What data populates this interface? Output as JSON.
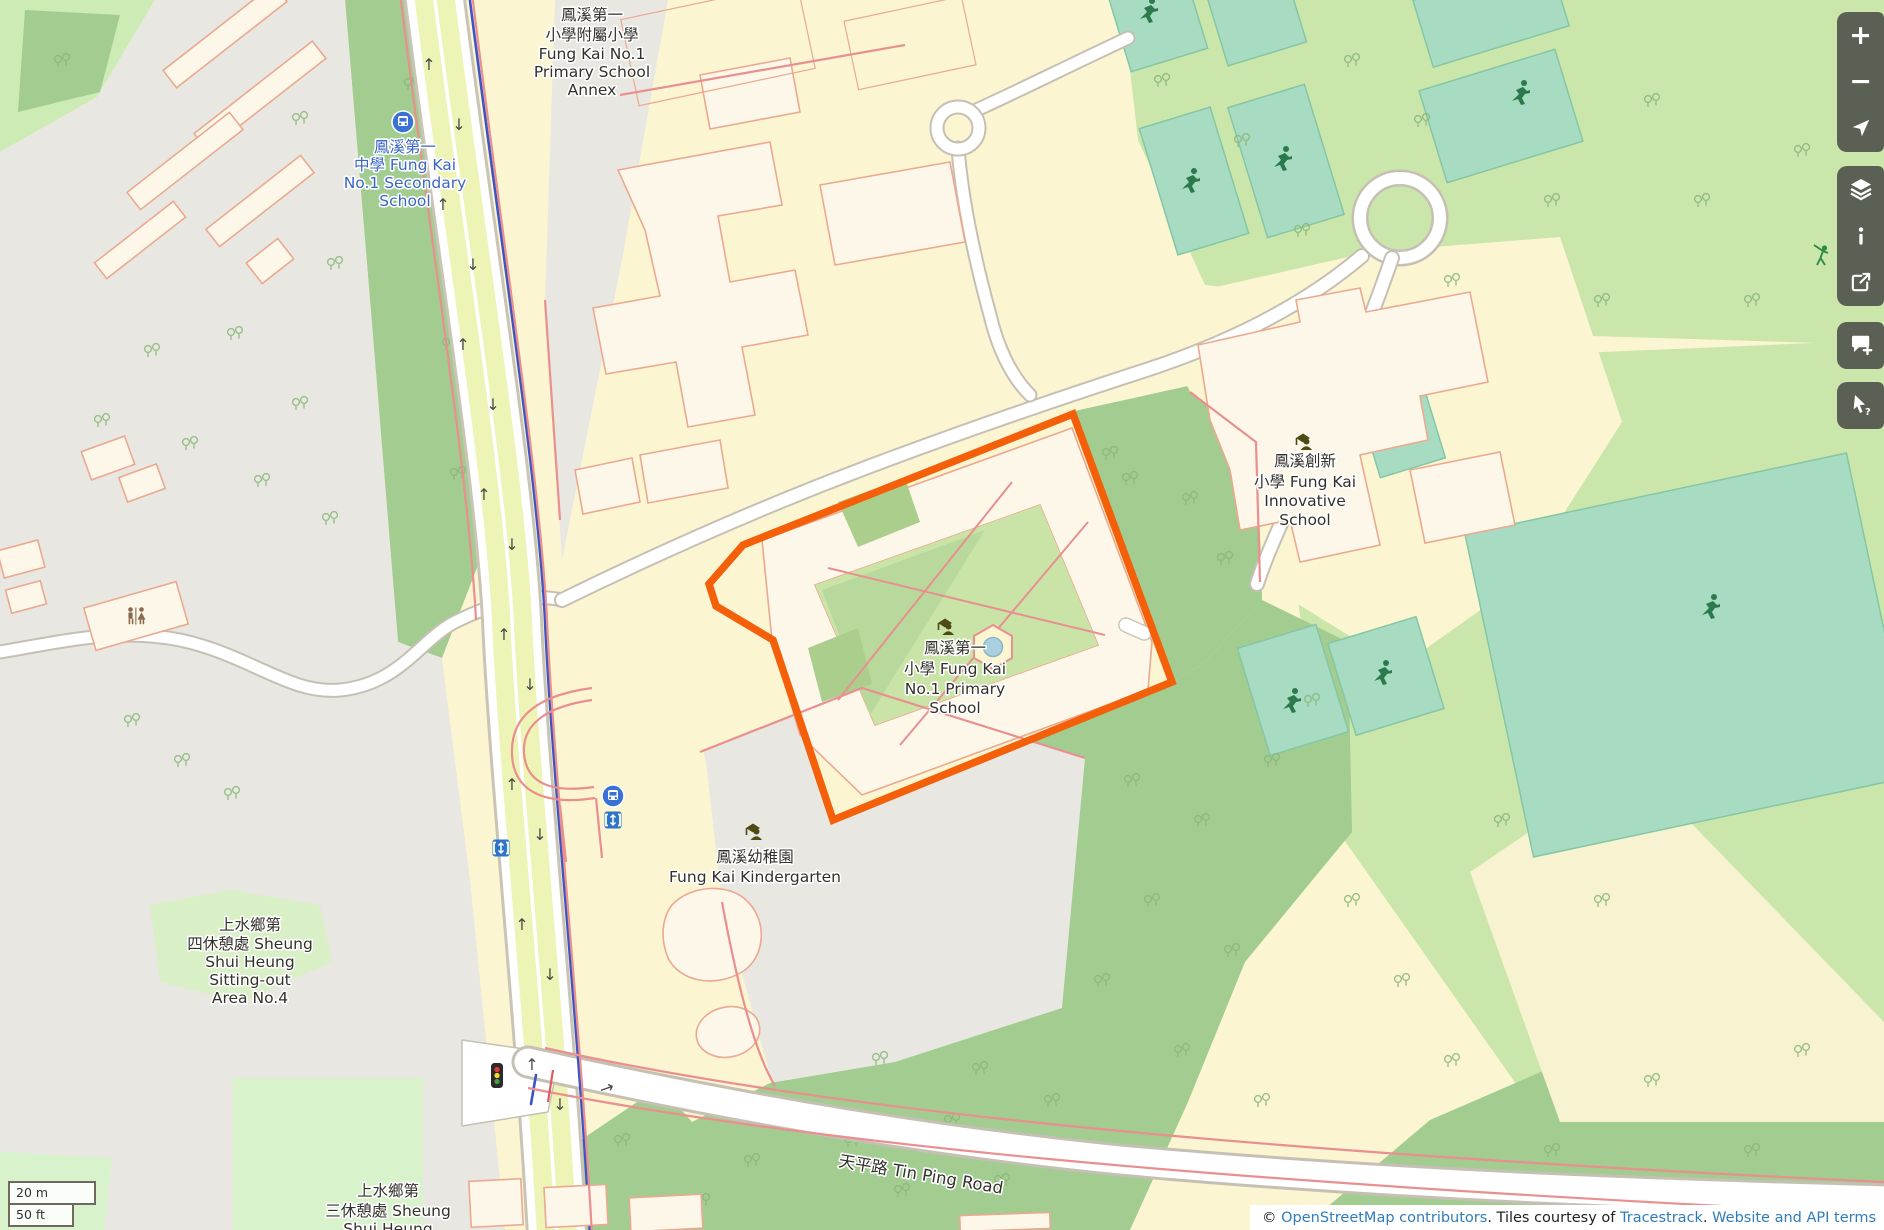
{
  "map": {
    "highlight_color": "#f4600a",
    "labels": {
      "annex": {
        "lines": [
          "鳳溪第一",
          "小學附屬小學",
          "Fung Kai No.1",
          "Primary School",
          "Annex"
        ]
      },
      "secondary": {
        "lines": [
          "鳳溪第一",
          "中學 Fung Kai",
          "No.1 Secondary",
          "School"
        ]
      },
      "primary": {
        "lines": [
          "鳳溪第一",
          "小學 Fung Kai",
          "No.1 Primary",
          "School"
        ]
      },
      "innovative": {
        "lines": [
          "鳳溪創新",
          "小學 Fung Kai",
          "Innovative",
          "School"
        ]
      },
      "kindergarten": {
        "lines": [
          "鳳溪幼稚園",
          "Fung Kai Kindergarten"
        ]
      },
      "sitting_out_area_4": {
        "lines": [
          "上水鄉第",
          "四休憩處 Sheung",
          "Shui Heung",
          "Sitting-out",
          "Area No.4"
        ]
      },
      "sitting_out_area_3": {
        "lines": [
          "上水鄉第",
          "三休憩處 Sheung",
          "Shui Heung"
        ]
      },
      "tin_ping_road": "天平路 Tin Ping Road"
    }
  },
  "controls": {
    "zoom_in": "+",
    "zoom_out": "−",
    "locate": "show-my-location",
    "layers": "layers",
    "info": "map-information",
    "share": "share",
    "add_note": "add-a-note",
    "query": "query-features"
  },
  "scalebar": {
    "metric": "20 m",
    "imperial": "50 ft"
  },
  "attribution": {
    "prefix": "© ",
    "osm_link": "OpenStreetMap contributors",
    "tiles_text": ". Tiles courtesy of ",
    "tracestrack_link": "Tracestrack",
    "dot": ". ",
    "terms_link": "Website and API terms"
  }
}
